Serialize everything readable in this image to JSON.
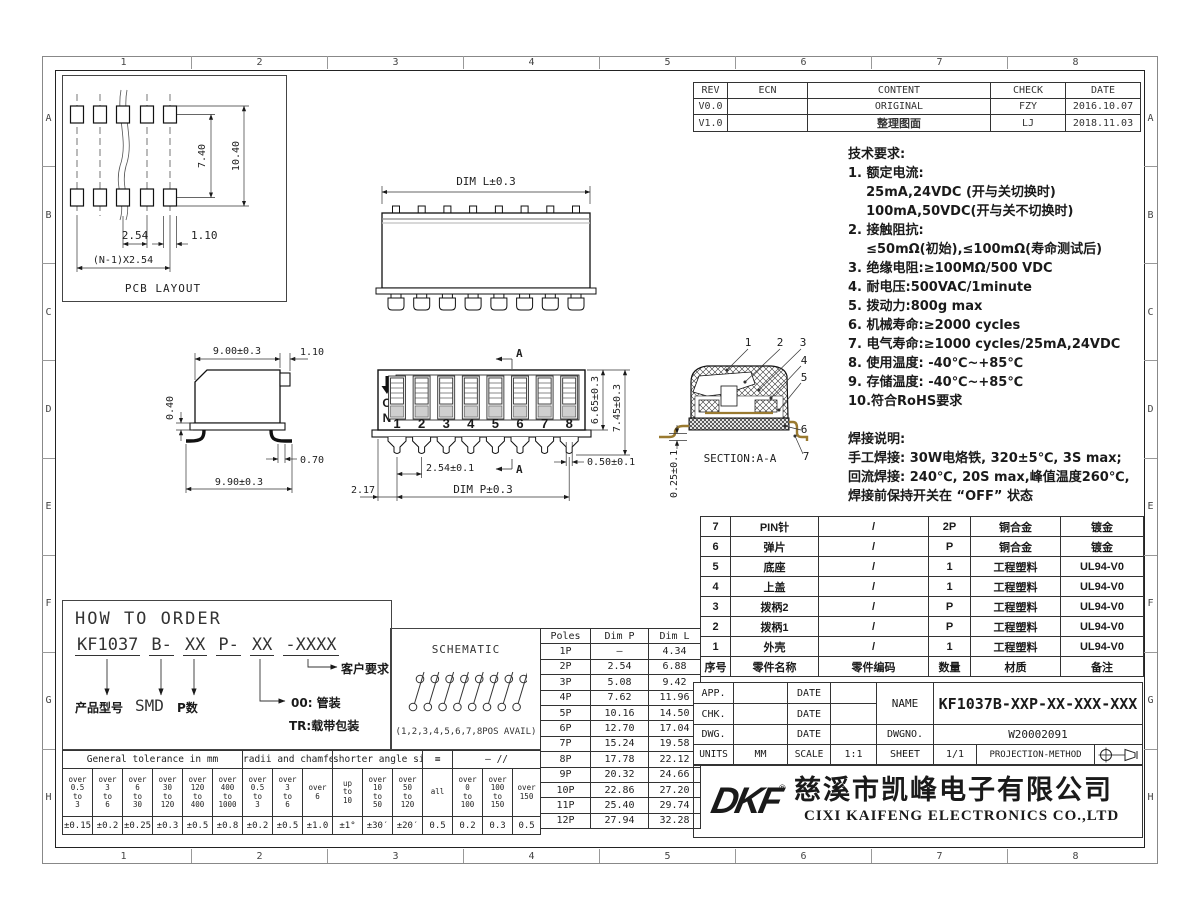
{
  "frame": {
    "cols": [
      "1",
      "2",
      "3",
      "4",
      "5",
      "6",
      "7",
      "8"
    ],
    "rows": [
      "A",
      "B",
      "C",
      "D",
      "E",
      "F",
      "G",
      "H"
    ]
  },
  "rev": {
    "headers": [
      "REV",
      "ECN",
      "CONTENT",
      "CHECK",
      "DATE"
    ],
    "rows": [
      [
        "V0.0",
        "",
        "ORIGINAL",
        "FZY",
        "2016.10.07"
      ],
      [
        "V1.0",
        "",
        "整理图面",
        "LJ",
        "2018.11.03"
      ]
    ]
  },
  "tech": {
    "title": "技术要求:",
    "items": [
      "1. 额定电流:",
      "    25mA,24VDC (开与关切换时)",
      "    100mA,50VDC(开与关不切换时)",
      "2. 接触阻抗:",
      "    ≤50mΩ(初始),≤100mΩ(寿命测试后)",
      "3. 绝缘电阻:≥100MΩ/500 VDC",
      "4. 耐电压:500VAC/1minute",
      "5. 拨动力:800g max",
      "6. 机械寿命:≥2000 cycles",
      "7. 电气寿命:≥1000 cycles/25mA,24VDC",
      "8. 使用温度: -40℃~+85℃",
      "9. 存储温度: -40℃~+85℃",
      "10.符合RoHS要求"
    ]
  },
  "solder": {
    "title": "焊接说明:",
    "lines": [
      "手工焊接: 30W电烙铁, 320±5℃, 3S max;",
      "回流焊接: 240℃, 20S max,峰值温度260℃,",
      "焊接前保持开关在 “OFF” 状态"
    ]
  },
  "parts": {
    "rows": [
      [
        "7",
        "PIN针",
        "/",
        "2P",
        "铜合金",
        "镀金"
      ],
      [
        "6",
        "弹片",
        "/",
        "P",
        "铜合金",
        "镀金"
      ],
      [
        "5",
        "底座",
        "/",
        "1",
        "工程塑料",
        "UL94-V0"
      ],
      [
        "4",
        "上盖",
        "/",
        "1",
        "工程塑料",
        "UL94-V0"
      ],
      [
        "3",
        "拨柄2",
        "/",
        "P",
        "工程塑料",
        "UL94-V0"
      ],
      [
        "2",
        "拨柄1",
        "/",
        "P",
        "工程塑料",
        "UL94-V0"
      ],
      [
        "1",
        "外壳",
        "/",
        "1",
        "工程塑料",
        "UL94-V0"
      ]
    ],
    "footer": [
      "序号",
      "零件名称",
      "零件编码",
      "数量",
      "材质",
      "备注"
    ]
  },
  "tb": {
    "app": "APP.",
    "chk": "CHK.",
    "dwg": "DWG.",
    "date1": "DATE",
    "date2": "DATE",
    "date3": "DATE",
    "name_l": "NAME",
    "name_v": "KF1037B-XXP-XX-XXX-XXX",
    "dwgno_l": "DWGNO.",
    "dwgno_v": "W20002091",
    "units_l": "UNITS",
    "units_v": "MM",
    "scale_l": "SCALE",
    "scale_v": "1:1",
    "sheet_l": "SHEET",
    "sheet_v": "1/1",
    "proj": "PROJECTION-METHOD"
  },
  "company": {
    "logo": "DKF",
    "reg": "®",
    "cn": "慈溪市凯峰电子有限公司",
    "en": "CIXI KAIFENG ELECTRONICS CO.,LTD"
  },
  "pcb": {
    "caption": "PCB LAYOUT",
    "d_row": "7.40",
    "d_total": "10.40",
    "d_pitch": "2.54",
    "d_pad": "1.10",
    "d_span": "(N-1)X2.54"
  },
  "tv": {
    "d_len": "DIM L±0.3"
  },
  "sv": {
    "d_top": "9.00±0.3",
    "d_tab": "1.10",
    "d_step": "0.40",
    "d_leg": "0.70",
    "d_bot": "9.90±0.3"
  },
  "fv": {
    "on": [
      "O",
      "N"
    ],
    "pos": [
      "1",
      "2",
      "3",
      "4",
      "5",
      "6",
      "7",
      "8"
    ],
    "sec_top": "A",
    "sec_bot": "A",
    "d_h1": "6.65±0.3",
    "d_h2": "7.45±0.3",
    "d_pin": "0.50±0.1",
    "d_pitch": "2.54±0.1",
    "d_edge": "2.17",
    "d_span": "DIM P±0.3"
  },
  "sec": {
    "caption": "SECTION:A-A",
    "callouts": [
      "1",
      "2",
      "3",
      "4",
      "5",
      "6",
      "7"
    ],
    "d_pin": "0.25±0.1"
  },
  "order": {
    "title": "HOW TO ORDER",
    "segs": [
      "KF1037",
      "B-",
      "XX",
      "P-",
      "XX",
      "-XXXX"
    ],
    "lbl_model": "产品型号",
    "lbl_smd": "SMD",
    "lbl_p": "P数",
    "lbl_tube": "00: 管装",
    "lbl_tr": "TR:载带包装",
    "lbl_cust": "客户要求"
  },
  "schematic": {
    "title": "SCHEMATIC",
    "caption": "(1,2,3,4,5,6,7,8POS AVAIL)"
  },
  "tol": {
    "groups": [
      "General tolerance in mm",
      "radii and chamfers",
      "shorter angle side",
      "≡",
      "—  //"
    ],
    "ranges": [
      "over\n0.5\nto\n3",
      "over\n3\nto\n6",
      "over\n6\nto\n30",
      "over\n30\nto\n120",
      "over\n120\nto\n400",
      "over\n400\nto\n1000",
      "over\n0.5\nto\n3",
      "over\n3\nto\n6",
      "over\n6",
      "up\nto\n10",
      "over\n10\nto\n50",
      "over\n50\nto\n120",
      "all",
      "over\n0\nto\n100",
      "over\n100\nto\n150",
      "over\n150"
    ],
    "values": [
      "±0.15",
      "±0.2",
      "±0.25",
      "±0.3",
      "±0.5",
      "±0.8",
      "±0.2",
      "±0.5",
      "±1.0",
      "±1°",
      "±30′",
      "±20′",
      "0.5",
      "0.2",
      "0.3",
      "0.5"
    ]
  },
  "poles": {
    "headers": [
      "Poles",
      "Dim P",
      "Dim L"
    ],
    "rows": [
      [
        "1P",
        "—",
        "4.34"
      ],
      [
        "2P",
        "2.54",
        "6.88"
      ],
      [
        "3P",
        "5.08",
        "9.42"
      ],
      [
        "4P",
        "7.62",
        "11.96"
      ],
      [
        "5P",
        "10.16",
        "14.50"
      ],
      [
        "6P",
        "12.70",
        "17.04"
      ],
      [
        "7P",
        "15.24",
        "19.58"
      ],
      [
        "8P",
        "17.78",
        "22.12"
      ],
      [
        "9P",
        "20.32",
        "24.66"
      ],
      [
        "10P",
        "22.86",
        "27.20"
      ],
      [
        "11P",
        "25.40",
        "29.74"
      ],
      [
        "12P",
        "27.94",
        "32.28"
      ]
    ]
  },
  "colors": {
    "line": "#1a1a1a",
    "metal": "#9a7a30"
  }
}
